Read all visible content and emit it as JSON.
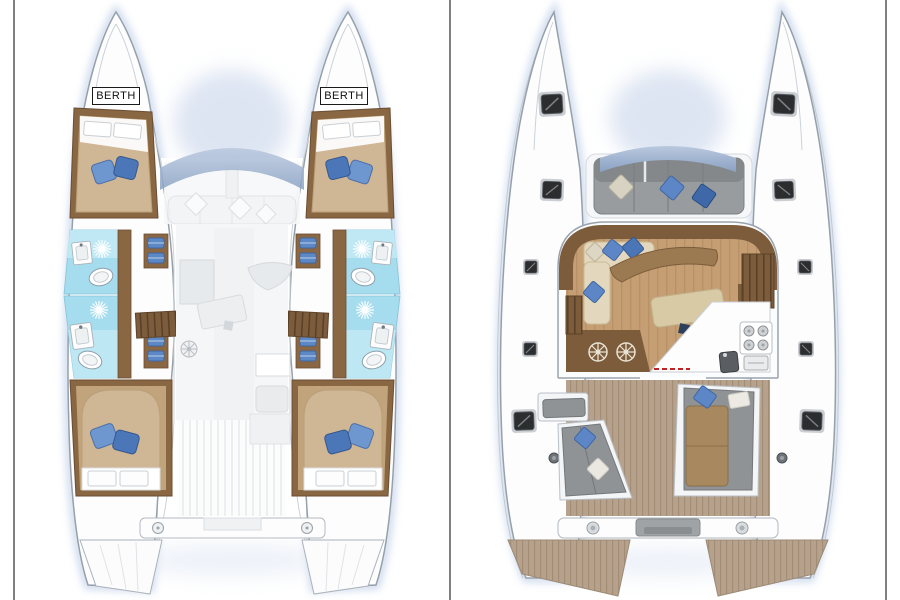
{
  "image": {
    "width": 900,
    "height": 600,
    "background": "#ffffff",
    "type": "catamaran-yacht-floorplan"
  },
  "plans": {
    "left": {
      "name": "hull-accommodation-plan",
      "berth_labels": {
        "port": "BERTH",
        "starboard": "BERTH"
      },
      "features": [
        "forepeak-berth",
        "forward-double-berth",
        "forward-bathroom",
        "aft-bathroom",
        "shower",
        "toilet",
        "washbasin",
        "towels",
        "companionway-steps",
        "aft-cabin-double-bed",
        "ghosted-saloon",
        "transom-crossbeam",
        "stern-steps"
      ]
    },
    "right": {
      "name": "main-deck-plan",
      "features": [
        "bow-deck-hatches",
        "forward-cockpit-seating",
        "coachroof-window",
        "saloon-l-sofa",
        "curved-bench",
        "coffee-table",
        "galley-stove",
        "galley-sink",
        "companionway-steps",
        "aft-cockpit-benches",
        "sunpad",
        "teak-cockpit-floor",
        "winches",
        "helm-step",
        "transom-platforms"
      ]
    }
  },
  "colors": {
    "divider": "#808080",
    "hull_fill": "#fdfdfe",
    "hull_stroke": "#96a0aa",
    "shadow_blue": "#aabfe0",
    "window_band": "#94abc9",
    "wood_floor": "#c59f73",
    "counter_brown": "#7d5c3c",
    "mattress": "#cfb694",
    "sofa_beige": "#e3d8bd",
    "pillow_blue": "#5d86c6",
    "pillow_blue_dark": "#4a76b8",
    "bathroom_cyan": "#a5dcee",
    "ghost_gray": "#e7eaec",
    "seat_gray": "#8f9396",
    "hatch_dark": "#2b2d2f",
    "teak": "#b6a28c",
    "accent_red": "#c22222"
  }
}
